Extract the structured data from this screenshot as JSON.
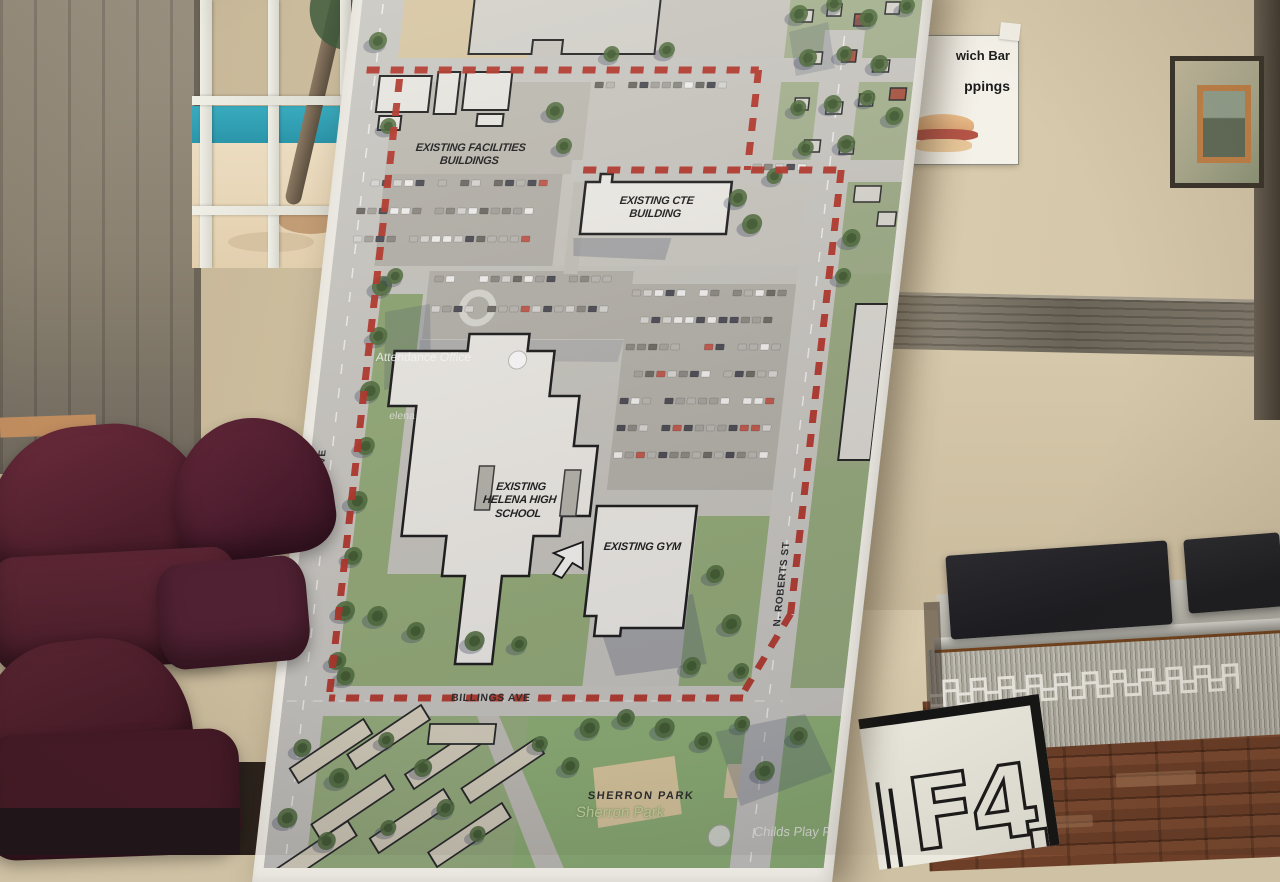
{
  "map": {
    "buildings": {
      "facilities": "EXISTING FACILITIES\nBUILDINGS",
      "cte": "EXISTING CTE\nBUILDING",
      "school": "EXISTING\nHELENA HIGH\nSCHOOL",
      "gym": "EXISTING GYM"
    },
    "streets": {
      "montana": "N. MONTANA AVE",
      "roberts": "N. ROBERTS ST",
      "billings": "BILLINGS AVE"
    },
    "places": {
      "park_caps": "SHERRON PARK",
      "park": "Sherron Park",
      "childs_play": "Childs Play Pr",
      "attendance": "Attendance Office",
      "helena_fragment": "elena H"
    },
    "colors": {
      "boundary_red": "#b23226",
      "lawn_green": "#92aa76",
      "building_white": "#edebe5",
      "street_gray": "#c9c7c1"
    }
  },
  "room": {
    "sandwich_sign": {
      "line1": "wich Bar",
      "line2": "ppings"
    },
    "letter_sign": {
      "letters": "F4",
      "partial_letter": "H"
    },
    "colors": {
      "wall_tan": "#cfc1a3",
      "chair_maroon": "#5e2635"
    }
  }
}
